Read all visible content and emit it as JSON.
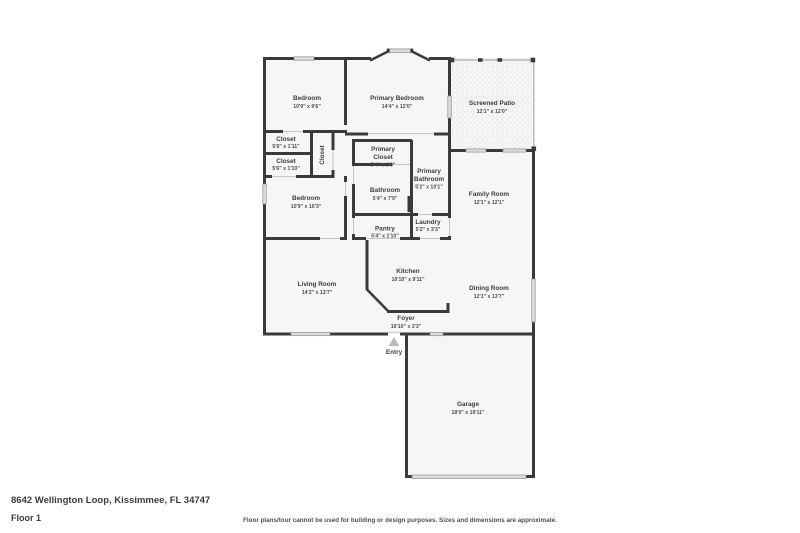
{
  "footer": {
    "address": "8642 Wellington Loop, Kissimmee, FL 34747",
    "floor_label": "Floor 1",
    "disclaimer": "Floor plans/tour cannot be used for building or design purposes. Sizes and dimensions are approximate."
  },
  "entry": {
    "label": "Entry"
  },
  "colors": {
    "wall": "#3a3a3a",
    "room_fill": "#f6f6f6",
    "window": "#dcdcdc",
    "patio_mesh": "#e6e6e6",
    "text": "#3d3d3d",
    "entry_arrow": "#b9b9b9"
  },
  "rooms": [
    {
      "id": "bedroom-1",
      "name": "Bedroom",
      "label_lines": [
        "Bedroom"
      ],
      "dims": "10'9\" x 9'6\""
    },
    {
      "id": "primary-bedroom",
      "name": "Primary Bedroom",
      "label_lines": [
        "Primary Bedroom"
      ],
      "dims": "14'4\" x 12'0\""
    },
    {
      "id": "screened-patio",
      "name": "Screened Patio",
      "label_lines": [
        "Screened Patio"
      ],
      "dims": "12'1\" x 12'0\""
    },
    {
      "id": "closet-1",
      "name": "Closet",
      "label_lines": [
        "Closet"
      ],
      "dims": "5'6\" x 1'11\""
    },
    {
      "id": "closet-2",
      "name": "Closet",
      "label_lines": [
        "Closet"
      ],
      "dims": "5'6\" x 1'10\""
    },
    {
      "id": "closet-vertical",
      "name": "Closet",
      "label_lines": [
        "Closet"
      ],
      "dims": ""
    },
    {
      "id": "primary-closet",
      "name": "Primary Closet",
      "label_lines": [
        "Primary",
        "Closet"
      ],
      "dims": "5'4\" x 3'9\""
    },
    {
      "id": "primary-bathroom",
      "name": "Primary Bathroom",
      "label_lines": [
        "Primary",
        "Bathroom"
      ],
      "dims": "5'2\" x 10'1\""
    },
    {
      "id": "bathroom",
      "name": "Bathroom",
      "label_lines": [
        "Bathroom"
      ],
      "dims": "5'4\" x 7'9\""
    },
    {
      "id": "family-room",
      "name": "Family Room",
      "label_lines": [
        "Family Room"
      ],
      "dims": "12'1\" x 12'1\""
    },
    {
      "id": "bedroom-2",
      "name": "Bedroom",
      "label_lines": [
        "Bedroom"
      ],
      "dims": "10'9\" x 10'3\""
    },
    {
      "id": "laundry",
      "name": "Laundry",
      "label_lines": [
        "Laundry"
      ],
      "dims": "5'2\" x 3'3\""
    },
    {
      "id": "pantry",
      "name": "Pantry",
      "label_lines": [
        "Pantry"
      ],
      "dims": "5'4\" x 1'10\""
    },
    {
      "id": "kitchen",
      "name": "Kitchen",
      "label_lines": [
        "Kitchen"
      ],
      "dims": "10'10\" x 9'11\""
    },
    {
      "id": "living-room",
      "name": "Living Room",
      "label_lines": [
        "Living Room"
      ],
      "dims": "14'2\" x 13'7\""
    },
    {
      "id": "dining-room",
      "name": "Dining Room",
      "label_lines": [
        "Dining Room"
      ],
      "dims": "12'1\" x 13'7\""
    },
    {
      "id": "foyer",
      "name": "Foyer",
      "label_lines": [
        "Foyer"
      ],
      "dims": "10'10\" x 3'3\""
    },
    {
      "id": "garage",
      "name": "Garage",
      "label_lines": [
        "Garage"
      ],
      "dims": "18'0\" x 19'11\""
    }
  ]
}
